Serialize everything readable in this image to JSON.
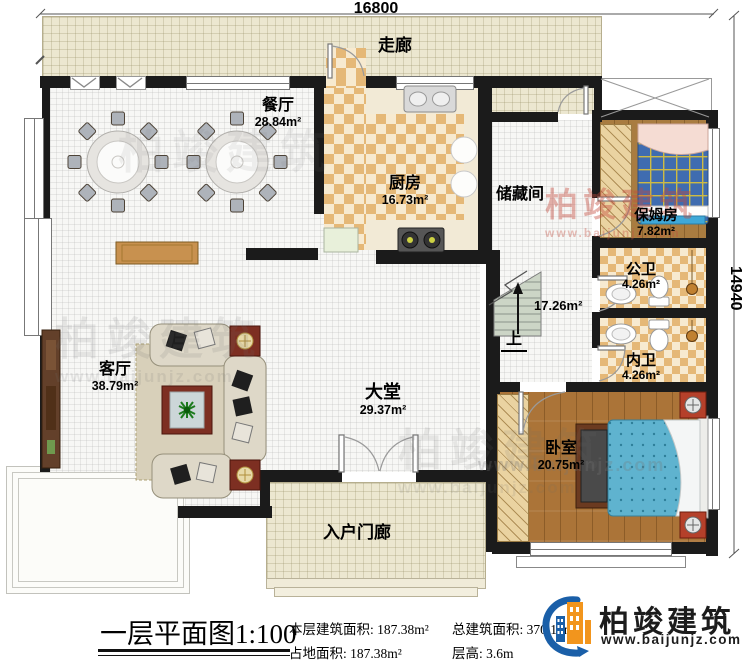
{
  "dimensions": {
    "width_top": "16800",
    "height_right": "14940"
  },
  "rooms": {
    "corridor": {
      "name": "走廊"
    },
    "dining": {
      "name": "餐厅",
      "area": "28.84m²"
    },
    "kitchen": {
      "name": "厨房",
      "area": "16.73m²"
    },
    "storage": {
      "name": "储藏间"
    },
    "stair_hall": {
      "area": "17.26m²",
      "up": "上"
    },
    "nanny": {
      "name": "保姆房",
      "area": "7.82m²"
    },
    "public_bath": {
      "name": "公卫",
      "area": "4.26m²"
    },
    "private_bath": {
      "name": "内卫",
      "area": "4.26m²"
    },
    "bedroom": {
      "name": "卧室",
      "area": "20.75m²"
    },
    "hall": {
      "name": "大堂",
      "area": "29.37m²"
    },
    "living": {
      "name": "客厅",
      "area": "38.79m²"
    },
    "porch": {
      "name": "入户门廊"
    }
  },
  "footer": {
    "title": "一层平面图",
    "scale": "1:100",
    "stats": [
      {
        "label": "本层建筑面积:",
        "value": "187.38m²"
      },
      {
        "label": "总建筑面积:",
        "value": "370.19m²"
      },
      {
        "label": "占地面积:",
        "value": "187.38m²"
      },
      {
        "label": "层高:",
        "value": "3.6m"
      }
    ]
  },
  "brand": {
    "name": "柏竣建筑",
    "url": "www.baijunjz.com",
    "blue": "#1a5fa8",
    "orange": "#f2951d"
  },
  "watermark": {
    "text": "柏竣建筑",
    "url": "www.baijunjz.com"
  }
}
